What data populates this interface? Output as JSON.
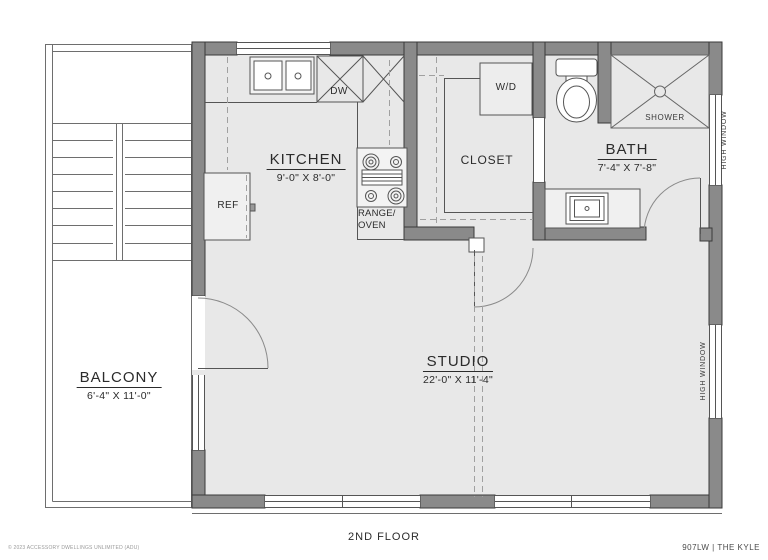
{
  "rooms": {
    "kitchen": {
      "name": "KITCHEN",
      "dims": "9'-0\" X 8'-0\""
    },
    "closet": {
      "name": "CLOSET"
    },
    "bath": {
      "name": "BATH",
      "dims": "7'-4\" X 7'-8\""
    },
    "studio": {
      "name": "STUDIO",
      "dims": "22'-0\" X 11'-4\""
    },
    "balcony": {
      "name": "BALCONY",
      "dims": "6'-4\" X 11'-0\""
    }
  },
  "fixtures": {
    "refrigerator": "REF",
    "dishwasher": "DW",
    "washer_dryer": "W/D",
    "range_line1": "RANGE/",
    "range_line2": "OVEN",
    "shower": "SHOWER"
  },
  "windows": {
    "right_upper": "HIGH WINDOW",
    "right_lower": "HIGH WINDOW"
  },
  "footer": {
    "floor_label": "2ND FLOOR",
    "plan_code": "907LW |  THE KYLE",
    "copyright": "© 2023 ACCESSORY DWELLINGS UNLIMITED (ADU)"
  },
  "colors": {
    "wall_fill": "#8a8a8a",
    "wall_stroke": "#3a3a3a",
    "floor_fill": "#e8e8e8",
    "thin_line": "#555555",
    "dashed_line": "#a0a0a0",
    "text": "#2b2b2b"
  }
}
